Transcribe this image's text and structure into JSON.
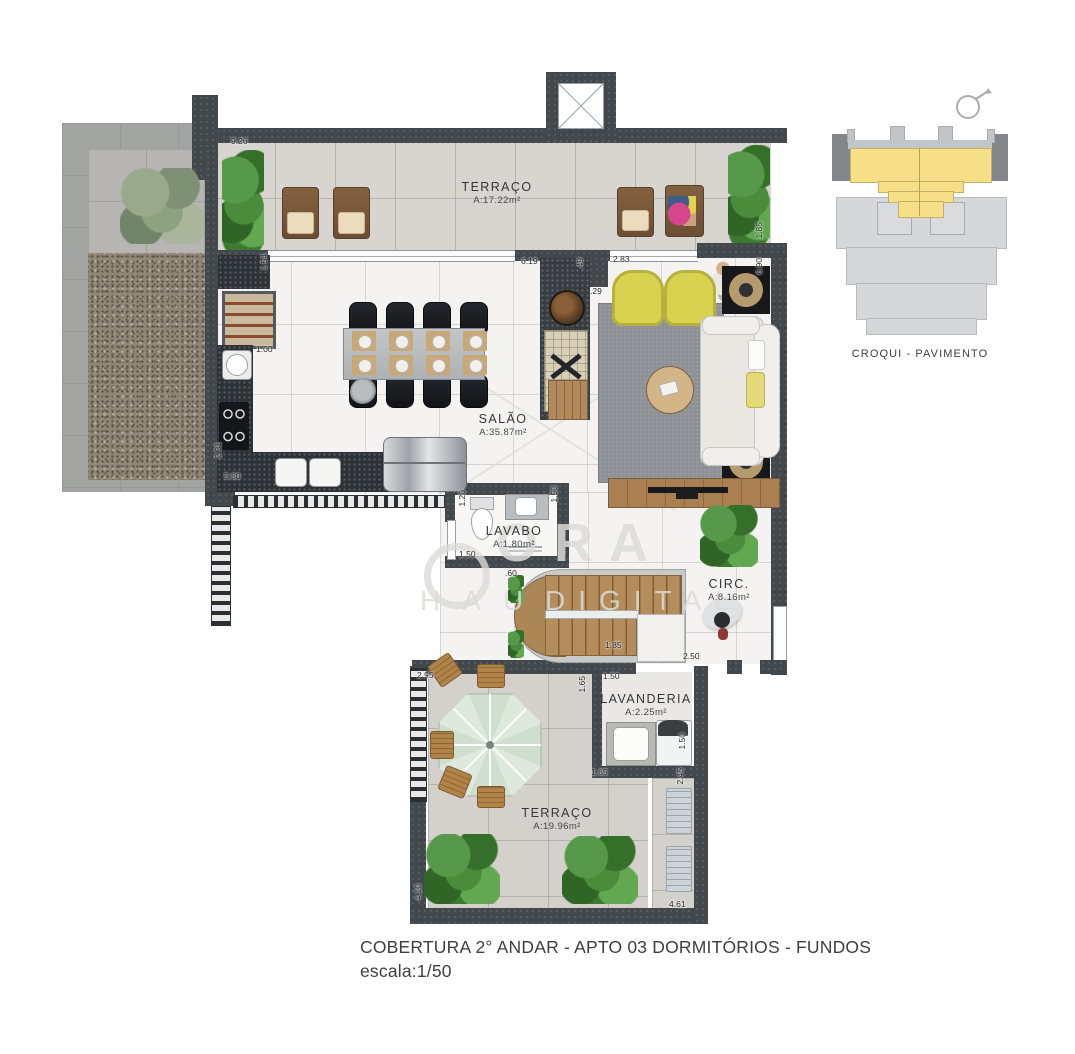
{
  "meta": {
    "title_line1": "COBERTURA 2° ANDAR - APTO  03  DORMITÓRIOS - FUNDOS",
    "title_line2": "escala:1/50"
  },
  "croqui": {
    "caption": "CROQUI - PAVIMENTO"
  },
  "icons": {
    "north_arrow": "compass-circle-arrow"
  },
  "watermark": {
    "word_main": "ORA",
    "word_left": "HAU",
    "word_right": "DIGITAL"
  },
  "rooms": [
    {
      "id": "terraco-top",
      "name": "TERRAÇO",
      "area": "A:17.22m²"
    },
    {
      "id": "salao",
      "name": "SALÃO",
      "area": "A:35.87m²"
    },
    {
      "id": "lavabo",
      "name": "LAVABO",
      "area": "A:1.80m²"
    },
    {
      "id": "circ",
      "name": "CIRC.",
      "area": "A:8.16m²"
    },
    {
      "id": "lavanderia",
      "name": "LAVANDERIA",
      "area": "A:2.25m²"
    },
    {
      "id": "terraco-bottom",
      "name": "TERRAÇO",
      "area": "A:19.96m²"
    }
  ],
  "dims": [
    {
      "v": "9.26"
    },
    {
      "v": "1.54"
    },
    {
      "v": "1.00"
    },
    {
      "v": "6.19"
    },
    {
      "v": ".49"
    },
    {
      "v": ".29"
    },
    {
      "v": "2.83"
    },
    {
      "v": "1.85"
    },
    {
      "v": "6.90"
    },
    {
      "v": "2.31"
    },
    {
      "v": "5.80"
    },
    {
      "v": "1.20"
    },
    {
      "v": "1.50"
    },
    {
      "v": "1.50"
    },
    {
      "v": ".60"
    },
    {
      "v": "1.85"
    },
    {
      "v": "2.50"
    },
    {
      "v": "2.95"
    },
    {
      "v": "1.65"
    },
    {
      "v": "1.50"
    },
    {
      "v": "1.50"
    },
    {
      "v": "1.65"
    },
    {
      "v": "2.45"
    },
    {
      "v": "4.10"
    },
    {
      "v": "4.61"
    }
  ]
}
